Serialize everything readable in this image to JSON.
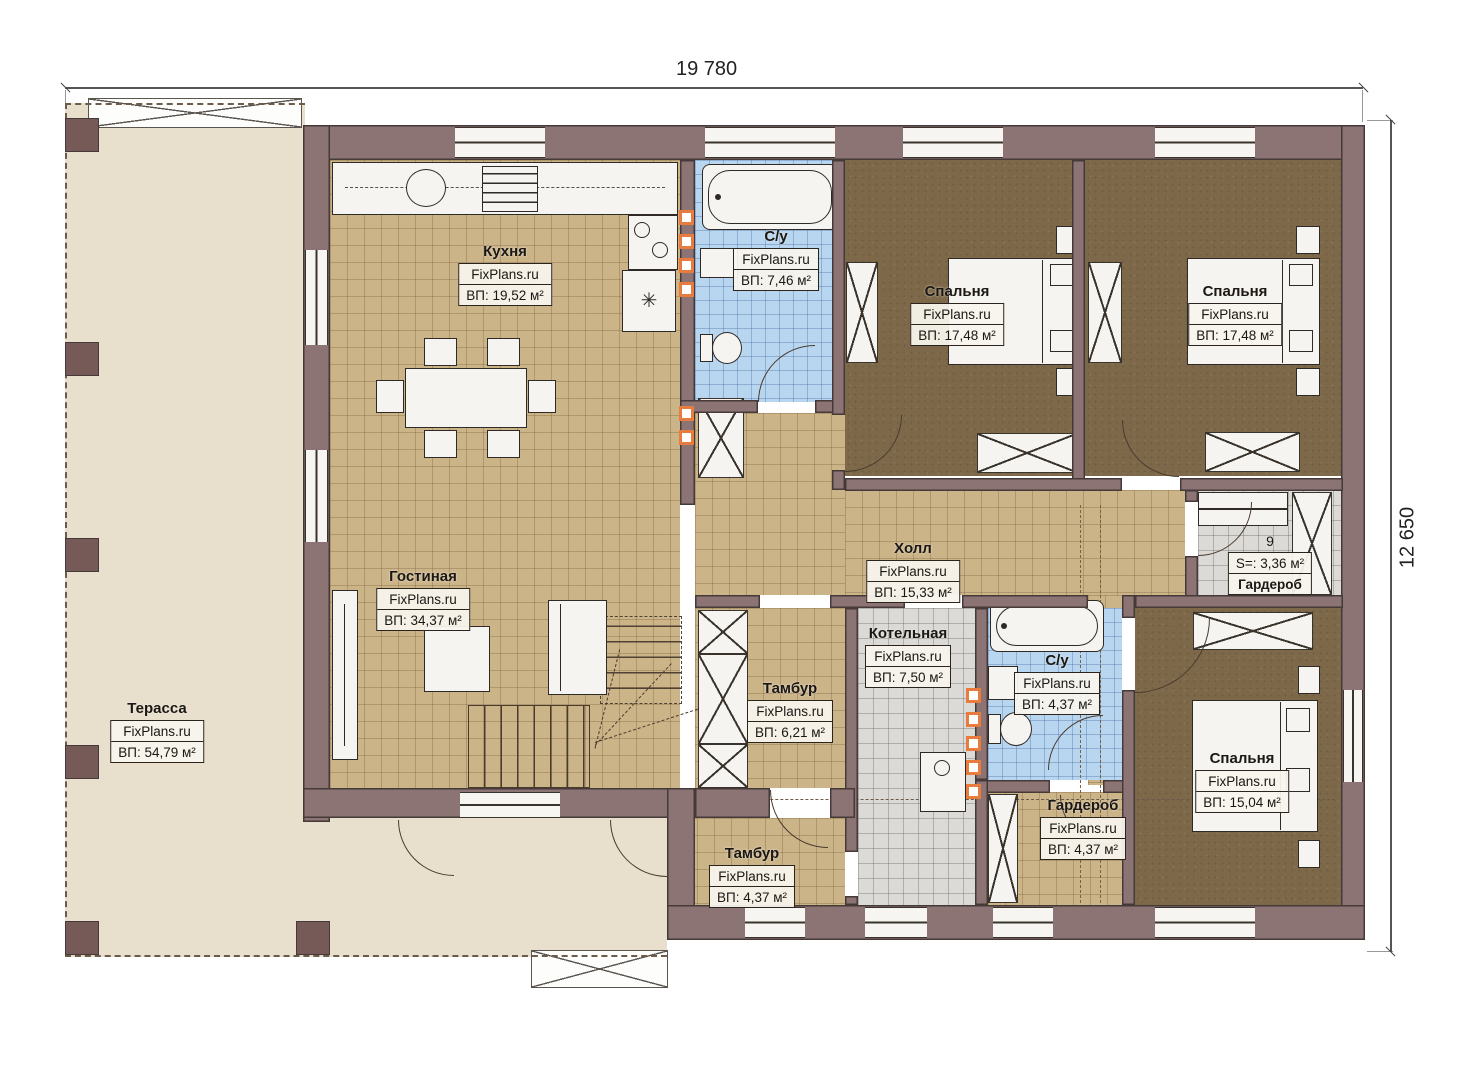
{
  "watermark": "FixPlans.ru",
  "dimensions": {
    "width_label": "19 780",
    "height_label": "12 650"
  },
  "rooms": [
    {
      "name": "Кухня",
      "area": "ВП: 19,52 м²"
    },
    {
      "name": "С/у",
      "area": "ВП: 7,46 м²"
    },
    {
      "name": "Спальня",
      "area": "ВП: 17,48 м²"
    },
    {
      "name": "Спальня",
      "area": "ВП: 17,48 м²"
    },
    {
      "name": "Терасса",
      "area": "ВП: 54,79 м²"
    },
    {
      "name": "Гостиная",
      "area": "ВП: 34,37 м²"
    },
    {
      "name": "Холл",
      "area": "ВП: 15,33 м²"
    },
    {
      "name": "Котельная",
      "area": "ВП: 7,50 м²"
    },
    {
      "name": "Тамбур",
      "area": "ВП: 6,21 м²"
    },
    {
      "name": "С/у",
      "area": "ВП: 4,37 м²"
    },
    {
      "name": "Тамбур",
      "area": "ВП: 4,37 м²"
    },
    {
      "name": "Гардероб",
      "area": "ВП: 4,37 м²"
    },
    {
      "name": "Спальня",
      "area": "ВП: 15,04 м²"
    },
    {
      "name": "Гардероб",
      "number": "9",
      "area": "S=: 3,36 м²"
    }
  ],
  "colors": {
    "wall": "#8b7473",
    "tile_tan": "#ccb489",
    "tile_blue": "#b9d6f0",
    "tile_gray": "#dbdad6",
    "carpet_brown": "#7d6949",
    "terrace": "#e9dfcd",
    "riser_accent": "#e87c3e"
  }
}
